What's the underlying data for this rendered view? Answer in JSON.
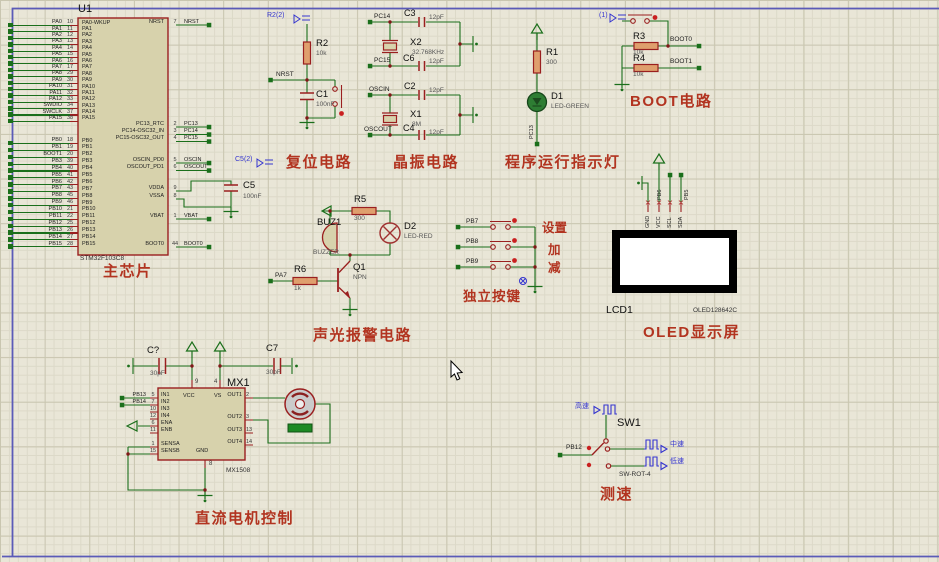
{
  "colors": {
    "wire": "#1b6f1b",
    "component_outline": "#9a1f1f",
    "section_title": "#b23420",
    "blue_label": "#3535cf",
    "sheet_border": "#5b5bb8"
  },
  "chip": {
    "ref": "U1",
    "part": "STM32F103C8",
    "title": "主芯片",
    "pa_rows": [
      {
        "net": "PA0",
        "num": "10",
        "pin": "PA0-WKUP"
      },
      {
        "net": "PA1",
        "num": "11",
        "pin": "PA1"
      },
      {
        "net": "PA2",
        "num": "12",
        "pin": "PA2"
      },
      {
        "net": "PA3",
        "num": "13",
        "pin": "PA3"
      },
      {
        "net": "PA4",
        "num": "14",
        "pin": "PA4"
      },
      {
        "net": "PA5",
        "num": "15",
        "pin": "PA5"
      },
      {
        "net": "PA6",
        "num": "16",
        "pin": "PA6"
      },
      {
        "net": "PA7",
        "num": "17",
        "pin": "PA7"
      },
      {
        "net": "PA8",
        "num": "29",
        "pin": "PA8"
      },
      {
        "net": "PA9",
        "num": "30",
        "pin": "PA9"
      },
      {
        "net": "PA10",
        "num": "31",
        "pin": "PA10"
      },
      {
        "net": "PA11",
        "num": "32",
        "pin": "PA11"
      },
      {
        "net": "PA12",
        "num": "33",
        "pin": "PA12"
      },
      {
        "net": "SWDIO",
        "num": "34",
        "pin": "PA13"
      },
      {
        "net": "SWCLK",
        "num": "37",
        "pin": "PA14"
      },
      {
        "net": "PA15",
        "num": "38",
        "pin": "PA15"
      }
    ],
    "pb_rows": [
      {
        "net": "PB0",
        "num": "18",
        "pin": "PB0"
      },
      {
        "net": "PB1",
        "num": "19",
        "pin": "PB1"
      },
      {
        "net": "BOOT1",
        "num": "20",
        "pin": "PB2"
      },
      {
        "net": "PB3",
        "num": "39",
        "pin": "PB3"
      },
      {
        "net": "PB4",
        "num": "40",
        "pin": "PB4"
      },
      {
        "net": "PB5",
        "num": "41",
        "pin": "PB5"
      },
      {
        "net": "PB6",
        "num": "42",
        "pin": "PB6"
      },
      {
        "net": "PB7",
        "num": "43",
        "pin": "PB7"
      },
      {
        "net": "PB8",
        "num": "45",
        "pin": "PB8"
      },
      {
        "net": "PB9",
        "num": "46",
        "pin": "PB9"
      },
      {
        "net": "PB10",
        "num": "21",
        "pin": "PB10"
      },
      {
        "net": "PB11",
        "num": "22",
        "pin": "PB11"
      },
      {
        "net": "PB12",
        "num": "25",
        "pin": "PB12"
      },
      {
        "net": "PB13",
        "num": "26",
        "pin": "PB13"
      },
      {
        "net": "PB14",
        "num": "27",
        "pin": "PB14"
      },
      {
        "net": "PB15",
        "num": "28",
        "pin": "PB15"
      }
    ],
    "right_rows": [
      {
        "pin": "NRST",
        "num": "7",
        "net": "NRST"
      },
      {
        "pin": "PC13_RTC",
        "num": "2",
        "net": "PC13"
      },
      {
        "pin": "PC14-OSC32_IN",
        "num": "3",
        "net": "PC14"
      },
      {
        "pin": "PC15-OSC32_OUT",
        "num": "4",
        "net": "PC15"
      },
      {
        "pin": "OSCIN_PD0",
        "num": "5",
        "net": "OSCIN"
      },
      {
        "pin": "OSCOUT_PD1",
        "num": "6",
        "net": "OSCOUT"
      },
      {
        "pin": "VDDA",
        "num": "9",
        "net": ""
      },
      {
        "pin": "VSSA",
        "num": "8",
        "net": ""
      },
      {
        "pin": "VBAT",
        "num": "1",
        "net": "VBAT"
      },
      {
        "pin": "BOOT0",
        "num": "44",
        "net": "BOOT0"
      }
    ]
  },
  "reset": {
    "flag": "R2(2)",
    "net": "NRST",
    "r_ref": "R2",
    "r_val": "10k",
    "c_ref": "C1",
    "c_val": "100nF",
    "title": "复位电路"
  },
  "decouple": {
    "flag": "C5(2)",
    "c_ref": "C5",
    "c_val": "100nF"
  },
  "crystal": {
    "title": "晶振电路",
    "groups": [
      {
        "top_net": "PC14",
        "top_cap": "C3",
        "top_val": "12pF",
        "xtal_ref": "X2",
        "xtal_val": "32.768KHz",
        "bot_net": "PC15",
        "bot_cap": "C6",
        "bot_val": "12pF"
      },
      {
        "top_net": "OSCIN",
        "top_cap": "C2",
        "top_val": "12pF",
        "xtal_ref": "X1",
        "xtal_val": "8M",
        "bot_net": "OSCOUT",
        "bot_cap": "C4",
        "bot_val": "12pF"
      }
    ]
  },
  "indicator": {
    "r_ref": "R1",
    "r_val": "300",
    "d_ref": "D1",
    "d_val": "LED-GREEN",
    "net": "PC13",
    "title": "程序运行指示灯"
  },
  "boot": {
    "flag": "(1)",
    "r3_ref": "R3",
    "r3_val": "10k",
    "net0": "BOOT0",
    "r4_ref": "R4",
    "r4_val": "10k",
    "net1": "BOOT1",
    "title": "BOOT电路"
  },
  "alarm": {
    "r5_ref": "R5",
    "r5_val": "300",
    "buz_ref": "BUZ1",
    "buz_val": "BUZZER",
    "d_ref": "D2",
    "d_val": "LED-RED",
    "q_ref": "Q1",
    "q_val": "NPN",
    "r6_ref": "R6",
    "r6_val": "1k",
    "net": "PA7",
    "title": "声光报警电路"
  },
  "keys": {
    "title": "独立按键",
    "rows": [
      {
        "net": "PB7",
        "label": "设置"
      },
      {
        "net": "PB8",
        "label": "加"
      },
      {
        "net": "PB9",
        "label": "减"
      }
    ]
  },
  "oled": {
    "ref": "LCD1",
    "part": "OLED128642C",
    "title": "OLED显示屏",
    "pins": [
      "GND",
      "VCC",
      "SCL",
      "SDA"
    ],
    "nets": [
      "PB6",
      "PB5"
    ]
  },
  "motor": {
    "title": "直流电机控制",
    "ref": "MX1",
    "part": "MX1508",
    "cap_left_ref": "C?",
    "cap_left_val": "30pF",
    "cap_right_ref": "C7",
    "cap_right_val": "30pF",
    "vcc_pin": {
      "num": "9",
      "name": "VCC"
    },
    "vs_pin": {
      "num": "4",
      "name": "VS"
    },
    "gnd_pin": {
      "num": "8",
      "name": "GND"
    },
    "left_pins": [
      {
        "net": "PB13",
        "num": "5",
        "name": "IN1"
      },
      {
        "net": "PB14",
        "num": "7",
        "name": "IN2"
      },
      {
        "net": "",
        "num": "10",
        "name": "IN3"
      },
      {
        "net": "",
        "num": "12",
        "name": "IN4"
      },
      {
        "net": "",
        "num": "6",
        "name": "ENA"
      },
      {
        "net": "",
        "num": "11",
        "name": "ENB"
      },
      {
        "net": "",
        "num": "1",
        "name": "SENSA"
      },
      {
        "net": "",
        "num": "15",
        "name": "SENSB"
      }
    ],
    "right_pins": [
      {
        "num": "2",
        "name": "OUT1"
      },
      {
        "num": "3",
        "name": "OUT2"
      },
      {
        "num": "13",
        "name": "OUT3"
      },
      {
        "num": "14",
        "name": "OUT4"
      }
    ]
  },
  "speed": {
    "ref": "SW1",
    "part": "SW-ROT-4",
    "net": "PB12",
    "labels": [
      "高速",
      "中速",
      "低速"
    ],
    "title": "测速"
  }
}
